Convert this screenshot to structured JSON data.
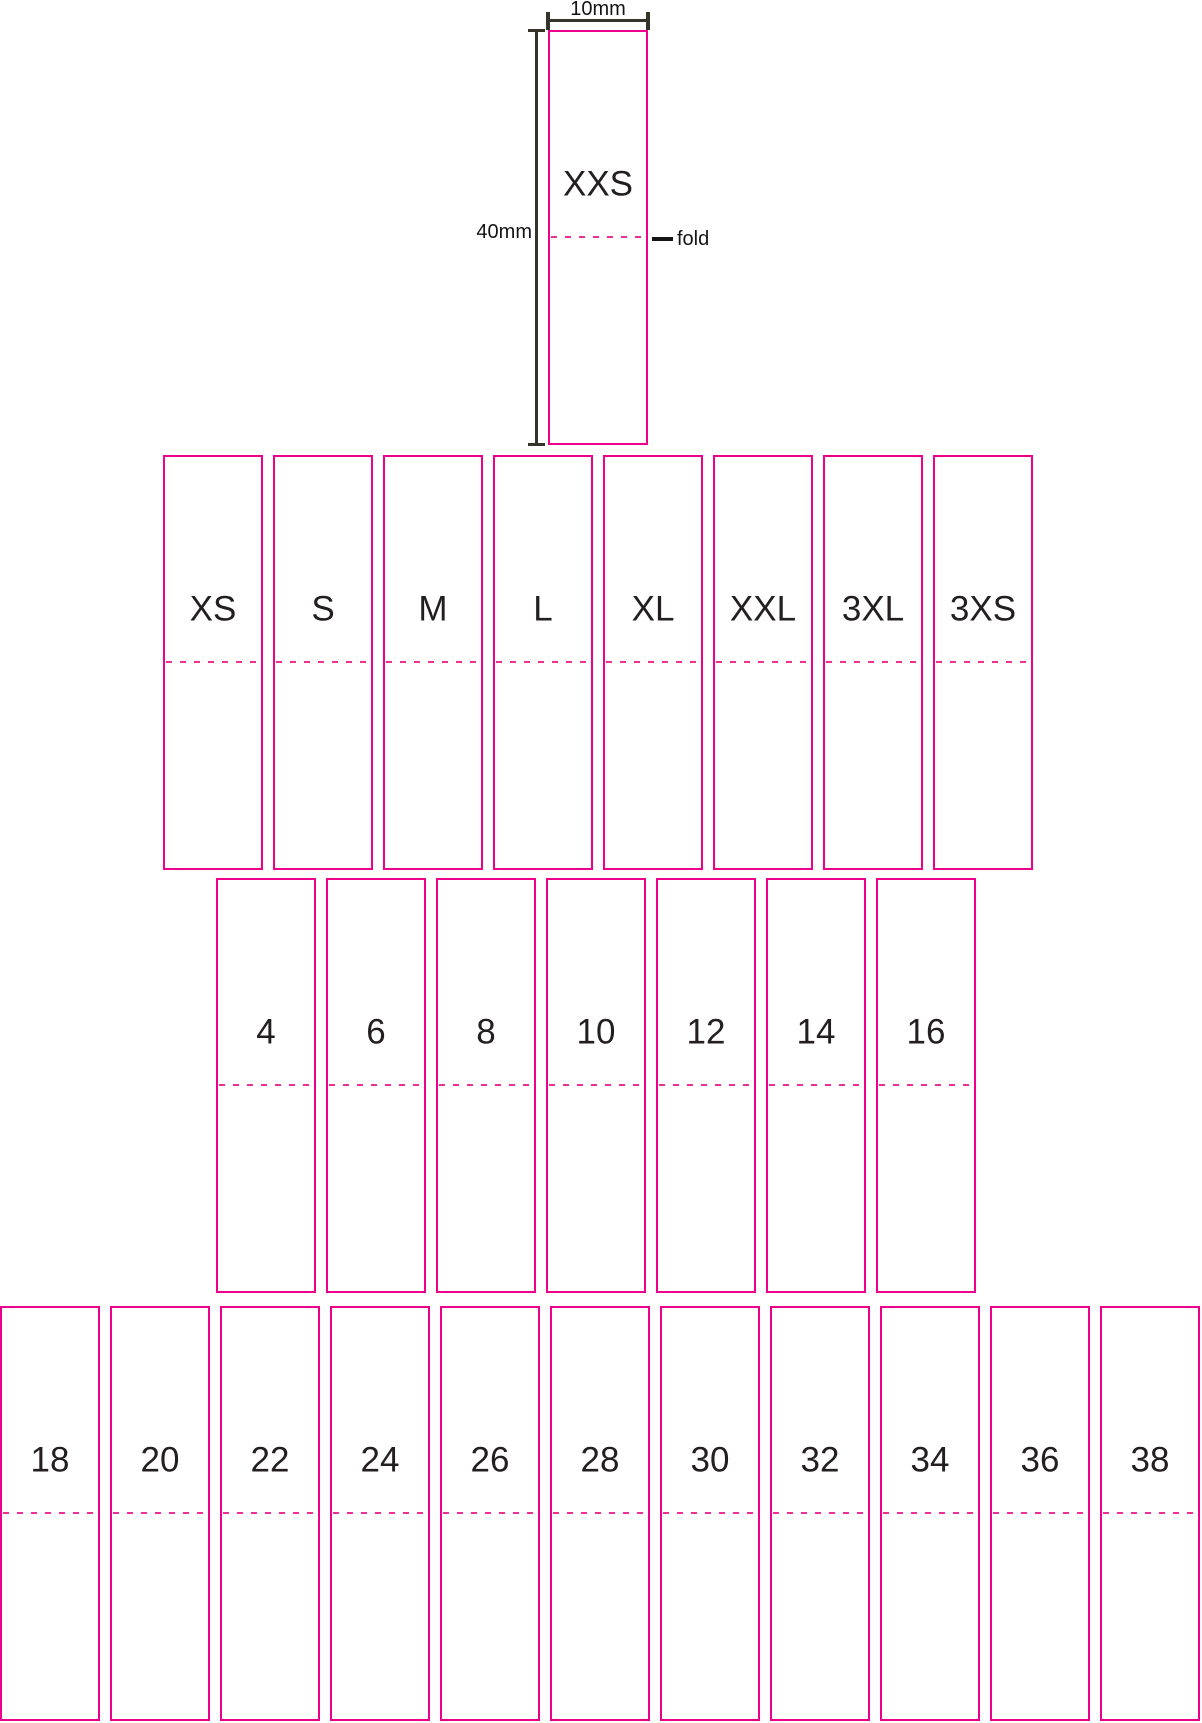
{
  "colors": {
    "label_border": "#ec008c",
    "fold_dash": "#ee2f96",
    "label_text": "#231f20",
    "dimension_line": "#35342b",
    "annotation_text": "#141414"
  },
  "dimensions": {
    "width_label": "10mm",
    "height_label": "40mm",
    "fold_label": "fold"
  },
  "xxs_label": {
    "text": "XXS"
  },
  "rows": [
    {
      "name": "letter-sizes",
      "labels": [
        "XS",
        "S",
        "M",
        "L",
        "XL",
        "XXL",
        "3XL",
        "3XS"
      ]
    },
    {
      "name": "kid-sizes",
      "labels": [
        "4",
        "6",
        "8",
        "10",
        "12",
        "14",
        "16"
      ]
    },
    {
      "name": "numeric-sizes",
      "labels": [
        "18",
        "20",
        "22",
        "24",
        "26",
        "28",
        "30",
        "32",
        "34",
        "36",
        "38"
      ]
    }
  ]
}
